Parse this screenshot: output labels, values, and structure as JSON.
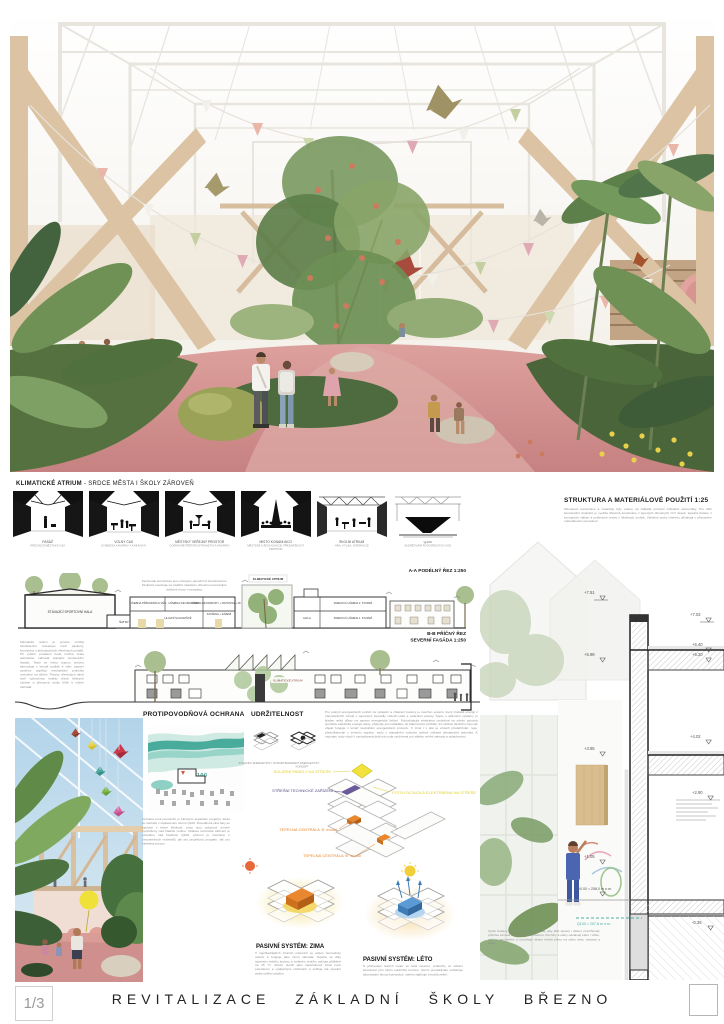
{
  "page": {
    "number": "1/3",
    "title": "REVITALIZACE ZÁKLADNÍ ŠKOLY BŘEZNO"
  },
  "colors": {
    "pink_floor": "#cf8a8c",
    "teal_flood": "#49ab9b",
    "solar_yellow": "#e8d44a",
    "heat_orange": "#e8872e",
    "cool_blue": "#5b9bd5",
    "tech_purple": "#6a5a9a",
    "timber": "#d9c0a2"
  },
  "atrium_strip": {
    "title_bold": "KLIMATICKÉ ATRIUM",
    "title_rest": " - SRDCE MĚSTA I ŠKOLY ZÁROVEŇ",
    "items": [
      {
        "label": "PASÁŽ",
        "sublabel": "PRŮCHOZÍ MĚSTSKÁ OSA"
      },
      {
        "label": "VOLNÝ ČAS",
        "sublabel": "SYMBIÓZA KAVÁRNY A KNIHOVNY"
      },
      {
        "label": "MĚSTSKÝ VEŘEJNÝ PROSTOR",
        "sublabel": "DOPRAVNĚ PĚŠÍ PROSTRANSTVÍ A KAVÁRNY"
      },
      {
        "label": "MÍSTO KONÁNÍ AKCÍ",
        "sublabel": "MĚSTSKÉ A ŠKOLNÍ AKCE, PŘEDNÁŠKOVÝ PROSTOR"
      },
      {
        "label": "ŠKOLNÍ ATRIUM",
        "sublabel": "HRA, VÝUKA, INTERAKCE"
      },
      {
        "label": "Q100",
        "sublabel": "ZADRŽOVÁNÍ POVODŇOVÝCH VOD"
      }
    ]
  },
  "section_aa": {
    "title": "A-A PODÉLNÝ ŘEZ 1:250",
    "note": "Zachovalé konstrukce jsou zdvojeny původními konstrukcemi. Struktura navazuje na tradiční nástavbu, dřevěnou konstrukci, viditelné krovy i mezipatra.",
    "rooms": {
      "hall": "STÁVAJÍCÍ SPORTOVNÍ HALA",
      "lockers": "ŠATNY",
      "science": "UČEBNA PŘÍRODNÍCH VĚD",
      "it": "UČEBNA INFORMATIKY",
      "library": "UČEBNA INFORMATIKY + KNIHOVNA + 3D TISK",
      "stairs": "HLAVNÍ SCHODIŠTĚ",
      "cafe": "KAVÁRNA + ZÁZEMÍ",
      "atrium": "KLIMATICKÉ ATRIUM",
      "hala": "HALA",
      "class2": "KMENOVÁ UČEBNA 2. STUPEŇ",
      "class1": "KMENOVÁ UČEBNA 1. STUPEŇ"
    }
  },
  "section_bb": {
    "title_line1": "B-B PŘÍČNÝ ŘEZ",
    "title_line2": "SEVERNÍ FASÁDA 1:250",
    "atrium_label": "KLIMATICKÉ ATRIUM",
    "paragraph": "Klimatické atrium je prostor vzniklý zastřešením rozestupu mezi pavilony, konstrukcí z jednoduchých dřevěných portálů. Při výběru prosklení bude možné zcela jednoduše nahradit stávající konstrukční fasádu. Teplo se mimo topnou sezónu akumuluje v hmotě podlah a stěn, pasivní systémy doplňují mechanické jednotky umístěné na střeše. Prostor dřevěných rámů tvoří výjimečnou kvalitu všech běžných učeben a přesouvá výuku blíže k vnitřní zahradě."
  },
  "structure_detail": {
    "title": "STRUKTURA A MATERIÁLOVÉ POUŽITÍ 1:25",
    "paragraph": "Obvodové konstrukce a materiály byly voleny na základě principů cirkulární ekonomiky. Pro dílčí konstrukční doplnění je využita dřevěná konstrukce z lepených dřevěných CLT desek, tepelná izolace z konopných vláken a pohledové vrstvy z hliněných omítek. Viditelné prvky interiéru zůstávají v přiznaném materiálovém provedení.",
    "levels": [
      "+7.51",
      "+7.02",
      "+6.40",
      "+6.20",
      "+5.98",
      "+4.02",
      "+3.95",
      "+2.90",
      "+1.05",
      "±0.00 = 258,0 m n.m.",
      "-0.35"
    ],
    "flood_level": "Q100 = 257,8 m n.m.",
    "caption": "Výraz budovy je obnoven a navržen tak, aby dílčí úpravy i dětem umožňovaly příznivé a hravé zasahování do interiéru. Povrchy a stěny odolávají otěru i vlhku, sokl je omyvatelný a umožňuje dětem kreslit přímo na stěny atria, malovat a tvořit."
  },
  "flood": {
    "title": "PROTIPOVODŇOVÁ OCHRANA",
    "q_label": "Q100",
    "paragraph": "Ochrana proti povodním je klíčovým aspektem projektu, škola se nachází v záplavovém území Q100. Povodňová vlna řeky se nachází v těsné blízkosti, proto jsou pobytové úrovně vyzdviženy nad hladinu rozlivu. Veškeré technické zařízení je umístěno nad hladinou Q100, přízemí je navrženo z omyvatelných materiálů, jak pro projektový program, tak pro následný provoz."
  },
  "sustainability": {
    "title": "UDRŽITELNOST",
    "axon_captions": [
      "STÁVAJÍCÍ ENERGETICKÝ KONCEPT",
      "NAVRŽENÝ ENERGETICKÝ KONCEPT"
    ],
    "paragraph": "Pro pokrytí energetických potřeb na vytápění a chlazení budovy je navržen systém, který získává energii z obnovitelných zdrojů s tepelnými čerpadly vzduch-voda a solárními panely. Spolu s aktivními systémy je kladen velký důraz na pasivní energetické řešení. Fotovoltaická elektrárna umístěná na střeše pokrývá spotřebu elektrické energie školy, přebytky jsou ukládány do bateriového úložiště. Po většinu školního roku tak objekt funguje v téměř neutrálním energetickém provozu. V zimě i v létě je vzduch předehříván, resp. předchlazován v zemním registru, teplo z odpadního vzduchu zpětně získává rekuperační jednotka. K úsporám vody slouží i zachytávaná dešťová voda využívaná pro zálivku vnitřní zahrady a splachování.",
    "labels": {
      "solar": "SOLÁRNÍ PANELY NA STŘEŠE",
      "roof_tech": "STŘEŠNÍ TECHNICKÉ ZAŘÍZENÍ",
      "pv": "FOTOVOLTAICKÁ ELEKTRÁRNA NA STŘEŠE",
      "heat_a": "TEPELNÁ CENTRÁLA 'A' modul",
      "heat_b": "TEPELNÁ CENTRÁLA 'B' modul"
    },
    "winter": {
      "title": "PASIVNÍ SYSTÉM: ZIMA",
      "paragraph": "V nejchladnějších zimních měsících se atrium hermeticky uzavře a funguje jako zimní zahrada. Teplota se díky tepelným ziskům budovy a solárním ziskům udržuje přibližně na 15 °C. Atrium slouží jako nárazníková zóna mezi exteriérem a vytápěnými učebnami a snižuje tak tepelné ztráty celého objektu."
    },
    "summer": {
      "title": "PASIVNÍ SYSTÉM: LÉTO",
      "paragraph": "S příchodem letních veder se atria otevřou, průduchy ve střešní konstrukci plní úlohu solárního komínu. Noční provětrávání ochlazuje akumulační hmoty konstrukcí, stínění zajišťuje vzrostlá zeleň."
    }
  }
}
